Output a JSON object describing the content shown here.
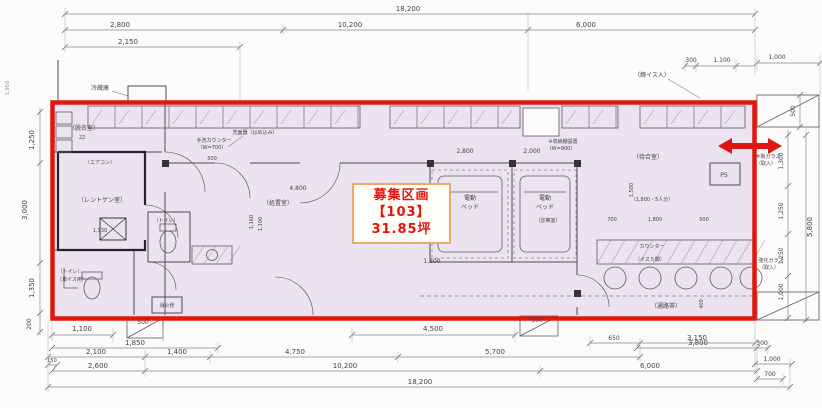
{
  "palette": {
    "red_outline": "#de1810",
    "area_fill": "#ece3f0",
    "label_border": "#efa868",
    "label_text": "#e8130e",
    "dim_text": "#44414c",
    "line": "#6b6878"
  },
  "label_box": {
    "line1": "募集区画",
    "line2": "【103】",
    "line3": "31.85坪"
  },
  "annotations": [
    {
      "t": "18,200",
      "x": 408,
      "y": 11
    },
    {
      "t": "2,800",
      "x": 120,
      "y": 27
    },
    {
      "t": "10,200",
      "x": 350,
      "y": 27
    },
    {
      "t": "6,000",
      "x": 586,
      "y": 27
    },
    {
      "t": "2,150",
      "x": 128,
      "y": 44
    },
    {
      "t": "300",
      "x": 691,
      "y": 62,
      "s": 6
    },
    {
      "t": "1,100",
      "x": 722,
      "y": 62,
      "s": 6
    },
    {
      "t": "1,000",
      "x": 777,
      "y": 59,
      "s": 6
    },
    {
      "t": "（飾イス入）",
      "x": 652,
      "y": 77,
      "s": 6,
      "n": "room-label"
    },
    {
      "t": "1,250",
      "x": 34,
      "y": 140,
      "r": -90
    },
    {
      "t": "3,000",
      "x": 27,
      "y": 210,
      "r": -90
    },
    {
      "t": "1,350",
      "x": 34,
      "y": 288,
      "r": -90
    },
    {
      "t": "200",
      "x": 31,
      "y": 324,
      "r": -90,
      "s": 6
    },
    {
      "t": "1,950",
      "x": 9,
      "y": 88,
      "r": -90,
      "s": 5,
      "c": "#8e8a98"
    },
    {
      "t": "500",
      "x": 795,
      "y": 111,
      "r": -90,
      "s": 6
    },
    {
      "t": "1,300",
      "x": 783,
      "y": 161,
      "r": -90,
      "s": 6
    },
    {
      "t": "1,250",
      "x": 783,
      "y": 211,
      "r": -90,
      "s": 6
    },
    {
      "t": "1,250",
      "x": 783,
      "y": 256,
      "r": -90,
      "s": 6
    },
    {
      "t": "1,000",
      "x": 783,
      "y": 292,
      "r": -90,
      "s": 6
    },
    {
      "t": "5,800",
      "x": 812,
      "y": 227,
      "r": -90
    },
    {
      "t": "木製ガラス",
      "x": 768,
      "y": 158,
      "s": 5,
      "n": "room-label"
    },
    {
      "t": "（取入）",
      "x": 766,
      "y": 165,
      "s": 5,
      "n": "room-label"
    },
    {
      "t": "強化ガラス",
      "x": 771,
      "y": 262,
      "s": 5,
      "n": "room-label"
    },
    {
      "t": "（取入）",
      "x": 769,
      "y": 269,
      "s": 5,
      "n": "room-label"
    },
    {
      "t": "1,100",
      "x": 82,
      "y": 331
    },
    {
      "t": "500",
      "x": 143,
      "y": 324,
      "s": 6
    },
    {
      "t": "4,500",
      "x": 433,
      "y": 331
    },
    {
      "t": "500",
      "x": 537,
      "y": 322,
      "s": 6
    },
    {
      "t": "650",
      "x": 614,
      "y": 340,
      "s": 6
    },
    {
      "t": "3,150",
      "x": 697,
      "y": 340
    },
    {
      "t": "1,850",
      "x": 135,
      "y": 345
    },
    {
      "t": "3,800",
      "x": 698,
      "y": 345
    },
    {
      "t": "300",
      "x": 762,
      "y": 345,
      "s": 6
    },
    {
      "t": "2,100",
      "x": 96,
      "y": 354
    },
    {
      "t": "1,400",
      "x": 177,
      "y": 354
    },
    {
      "t": "4,750",
      "x": 295,
      "y": 354
    },
    {
      "t": "5,700",
      "x": 495,
      "y": 354
    },
    {
      "t": "150",
      "x": 52,
      "y": 362,
      "s": 5
    },
    {
      "t": "1,000",
      "x": 772,
      "y": 361,
      "s": 6
    },
    {
      "t": "2,600",
      "x": 98,
      "y": 368
    },
    {
      "t": "10,200",
      "x": 345,
      "y": 368
    },
    {
      "t": "6,000",
      "x": 650,
      "y": 368
    },
    {
      "t": "700",
      "x": 770,
      "y": 376,
      "s": 6
    },
    {
      "t": "18,200",
      "x": 420,
      "y": 384
    },
    {
      "t": "冷蔵庫",
      "x": 100,
      "y": 90,
      "s": 6,
      "n": "room-label"
    },
    {
      "t": "（脱衣室）",
      "x": 84,
      "y": 130,
      "s": 6,
      "n": "room-label"
    },
    {
      "t": "22",
      "x": 82,
      "y": 139,
      "s": 5,
      "n": "room-label"
    },
    {
      "t": "（エアコン）",
      "x": 100,
      "y": 164,
      "s": 5,
      "n": "room-label"
    },
    {
      "t": "（レントゲン室）",
      "x": 102,
      "y": 202,
      "s": 6,
      "n": "room-label"
    },
    {
      "t": "1,930",
      "x": 100,
      "y": 232,
      "s": 5
    },
    {
      "t": "（トイレ）",
      "x": 70,
      "y": 273,
      "s": 5,
      "n": "room-label"
    },
    {
      "t": "（車イス用）",
      "x": 72,
      "y": 281,
      "s": 5,
      "n": "room-label"
    },
    {
      "t": "（トイレ）",
      "x": 166,
      "y": 222,
      "s": 5,
      "n": "room-label"
    },
    {
      "t": "手洗カウンター",
      "x": 214,
      "y": 142,
      "s": 5,
      "n": "room-label"
    },
    {
      "t": "（W=700）",
      "x": 212,
      "y": 149,
      "s": 5,
      "n": "room-label"
    },
    {
      "t": "洗面器（はめ込み）",
      "x": 255,
      "y": 134,
      "s": 5,
      "n": "room-label"
    },
    {
      "t": "500",
      "x": 212,
      "y": 160,
      "s": 5
    },
    {
      "t": "1,160",
      "x": 253,
      "y": 222,
      "r": -90,
      "s": 5
    },
    {
      "t": "1,100",
      "x": 262,
      "y": 224,
      "r": -90,
      "s": 5
    },
    {
      "t": "4,800",
      "x": 298,
      "y": 190,
      "s": 6
    },
    {
      "t": "（処置室）",
      "x": 278,
      "y": 205,
      "s": 6,
      "n": "room-label"
    },
    {
      "t": "消火栓",
      "x": 167,
      "y": 307,
      "s": 5,
      "n": "room-label"
    },
    {
      "t": "2,800",
      "x": 465,
      "y": 153,
      "s": 6
    },
    {
      "t": "2,000",
      "x": 532,
      "y": 153,
      "s": 6
    },
    {
      "t": "※収納棚設置",
      "x": 563,
      "y": 143,
      "s": 5,
      "n": "room-label"
    },
    {
      "t": "（W=900）",
      "x": 561,
      "y": 150,
      "s": 5,
      "n": "room-label"
    },
    {
      "t": "電動",
      "x": 470,
      "y": 200,
      "s": 6,
      "n": "room-label"
    },
    {
      "t": "ベッド",
      "x": 470,
      "y": 209,
      "s": 6,
      "n": "room-label"
    },
    {
      "t": "電動",
      "x": 545,
      "y": 200,
      "s": 6,
      "n": "room-label"
    },
    {
      "t": "ベッド",
      "x": 545,
      "y": 209,
      "s": 6,
      "n": "room-label"
    },
    {
      "t": "（診察室）",
      "x": 548,
      "y": 222,
      "s": 5,
      "n": "room-label"
    },
    {
      "t": "1,800",
      "x": 432,
      "y": 263,
      "s": 6
    },
    {
      "t": "（待合室）",
      "x": 648,
      "y": 159,
      "s": 6,
      "n": "room-label"
    },
    {
      "t": "（1,800・5人分）",
      "x": 652,
      "y": 201,
      "s": 5,
      "n": "room-label"
    },
    {
      "t": "1,500",
      "x": 633,
      "y": 190,
      "r": -90,
      "s": 5
    },
    {
      "t": "700",
      "x": 612,
      "y": 221,
      "s": 5
    },
    {
      "t": "1,800",
      "x": 655,
      "y": 221,
      "s": 5
    },
    {
      "t": "500",
      "x": 704,
      "y": 221,
      "s": 5
    },
    {
      "t": "カウンター",
      "x": 652,
      "y": 248,
      "s": 5,
      "n": "room-label"
    },
    {
      "t": "（イス５脚）",
      "x": 650,
      "y": 261,
      "s": 5,
      "n": "room-label"
    },
    {
      "t": "（通路帯）",
      "x": 666,
      "y": 308,
      "s": 6,
      "n": "room-label"
    },
    {
      "t": "400",
      "x": 703,
      "y": 304,
      "r": -90,
      "s": 5
    },
    {
      "t": "PS",
      "x": 724,
      "y": 177,
      "s": 6,
      "n": "room-label"
    }
  ]
}
